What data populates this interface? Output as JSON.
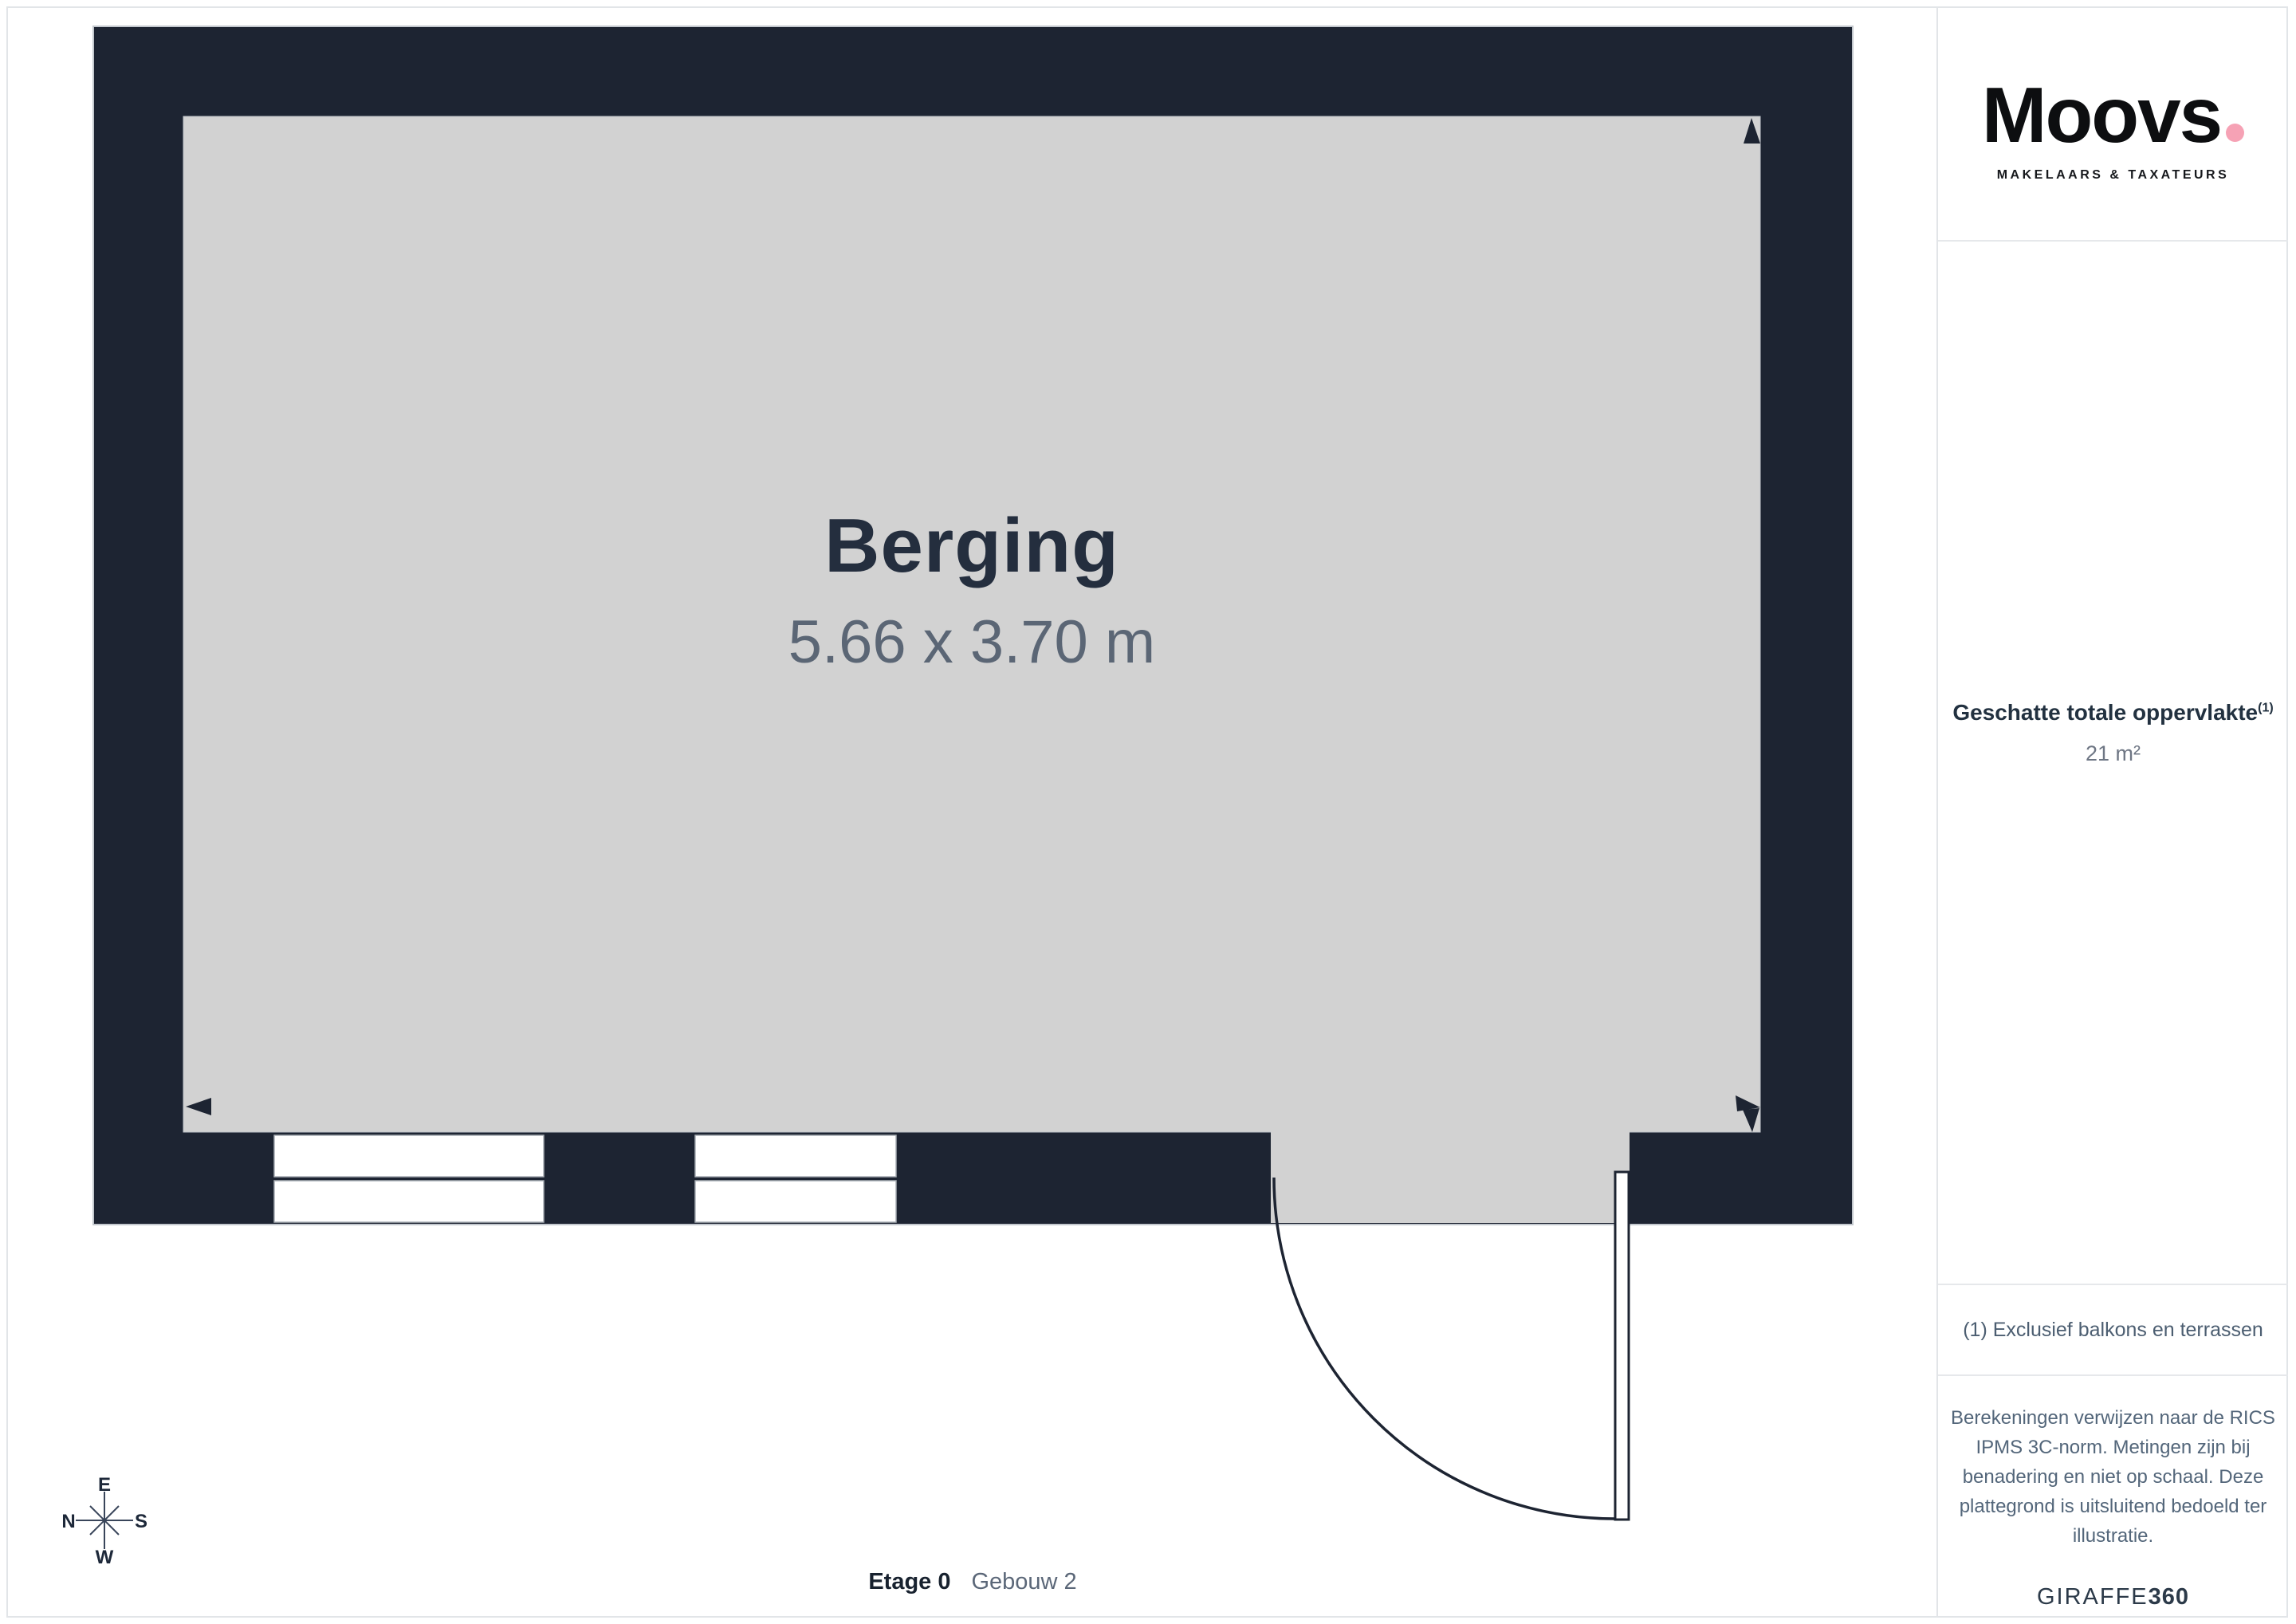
{
  "floorplan": {
    "room": {
      "name": "Berging",
      "dimensions": "5.66 x 3.70 m"
    },
    "footer": {
      "floor_label": "Etage 0",
      "building_label": "Gebouw 2"
    },
    "compass": {
      "top": "E",
      "left": "N",
      "right": "S",
      "bottom": "W"
    },
    "colors": {
      "wall": "#1d2432",
      "floor": "#d2d2d2",
      "room_name_text": "#242e3e",
      "room_dims_text": "#5b6675"
    }
  },
  "sidebar": {
    "logo": {
      "brand": "Moovs",
      "dot_color": "#f6a2b5",
      "tagline": "MAKELAARS & TAXATEURS"
    },
    "area": {
      "heading": "Geschatte totale oppervlakte",
      "heading_sup": "(1)",
      "value": "21 m²"
    },
    "footnote": "(1) Exclusief balkons en terrassen",
    "disclaimer": "Berekeningen verwijzen naar de RICS IPMS 3C-norm. Metingen zijn bij benadering en niet op schaal. Deze plattegrond is uitsluitend bedoeld ter illustratie.",
    "credit": {
      "brand": "GIRAFFE",
      "suffix": "360"
    }
  }
}
